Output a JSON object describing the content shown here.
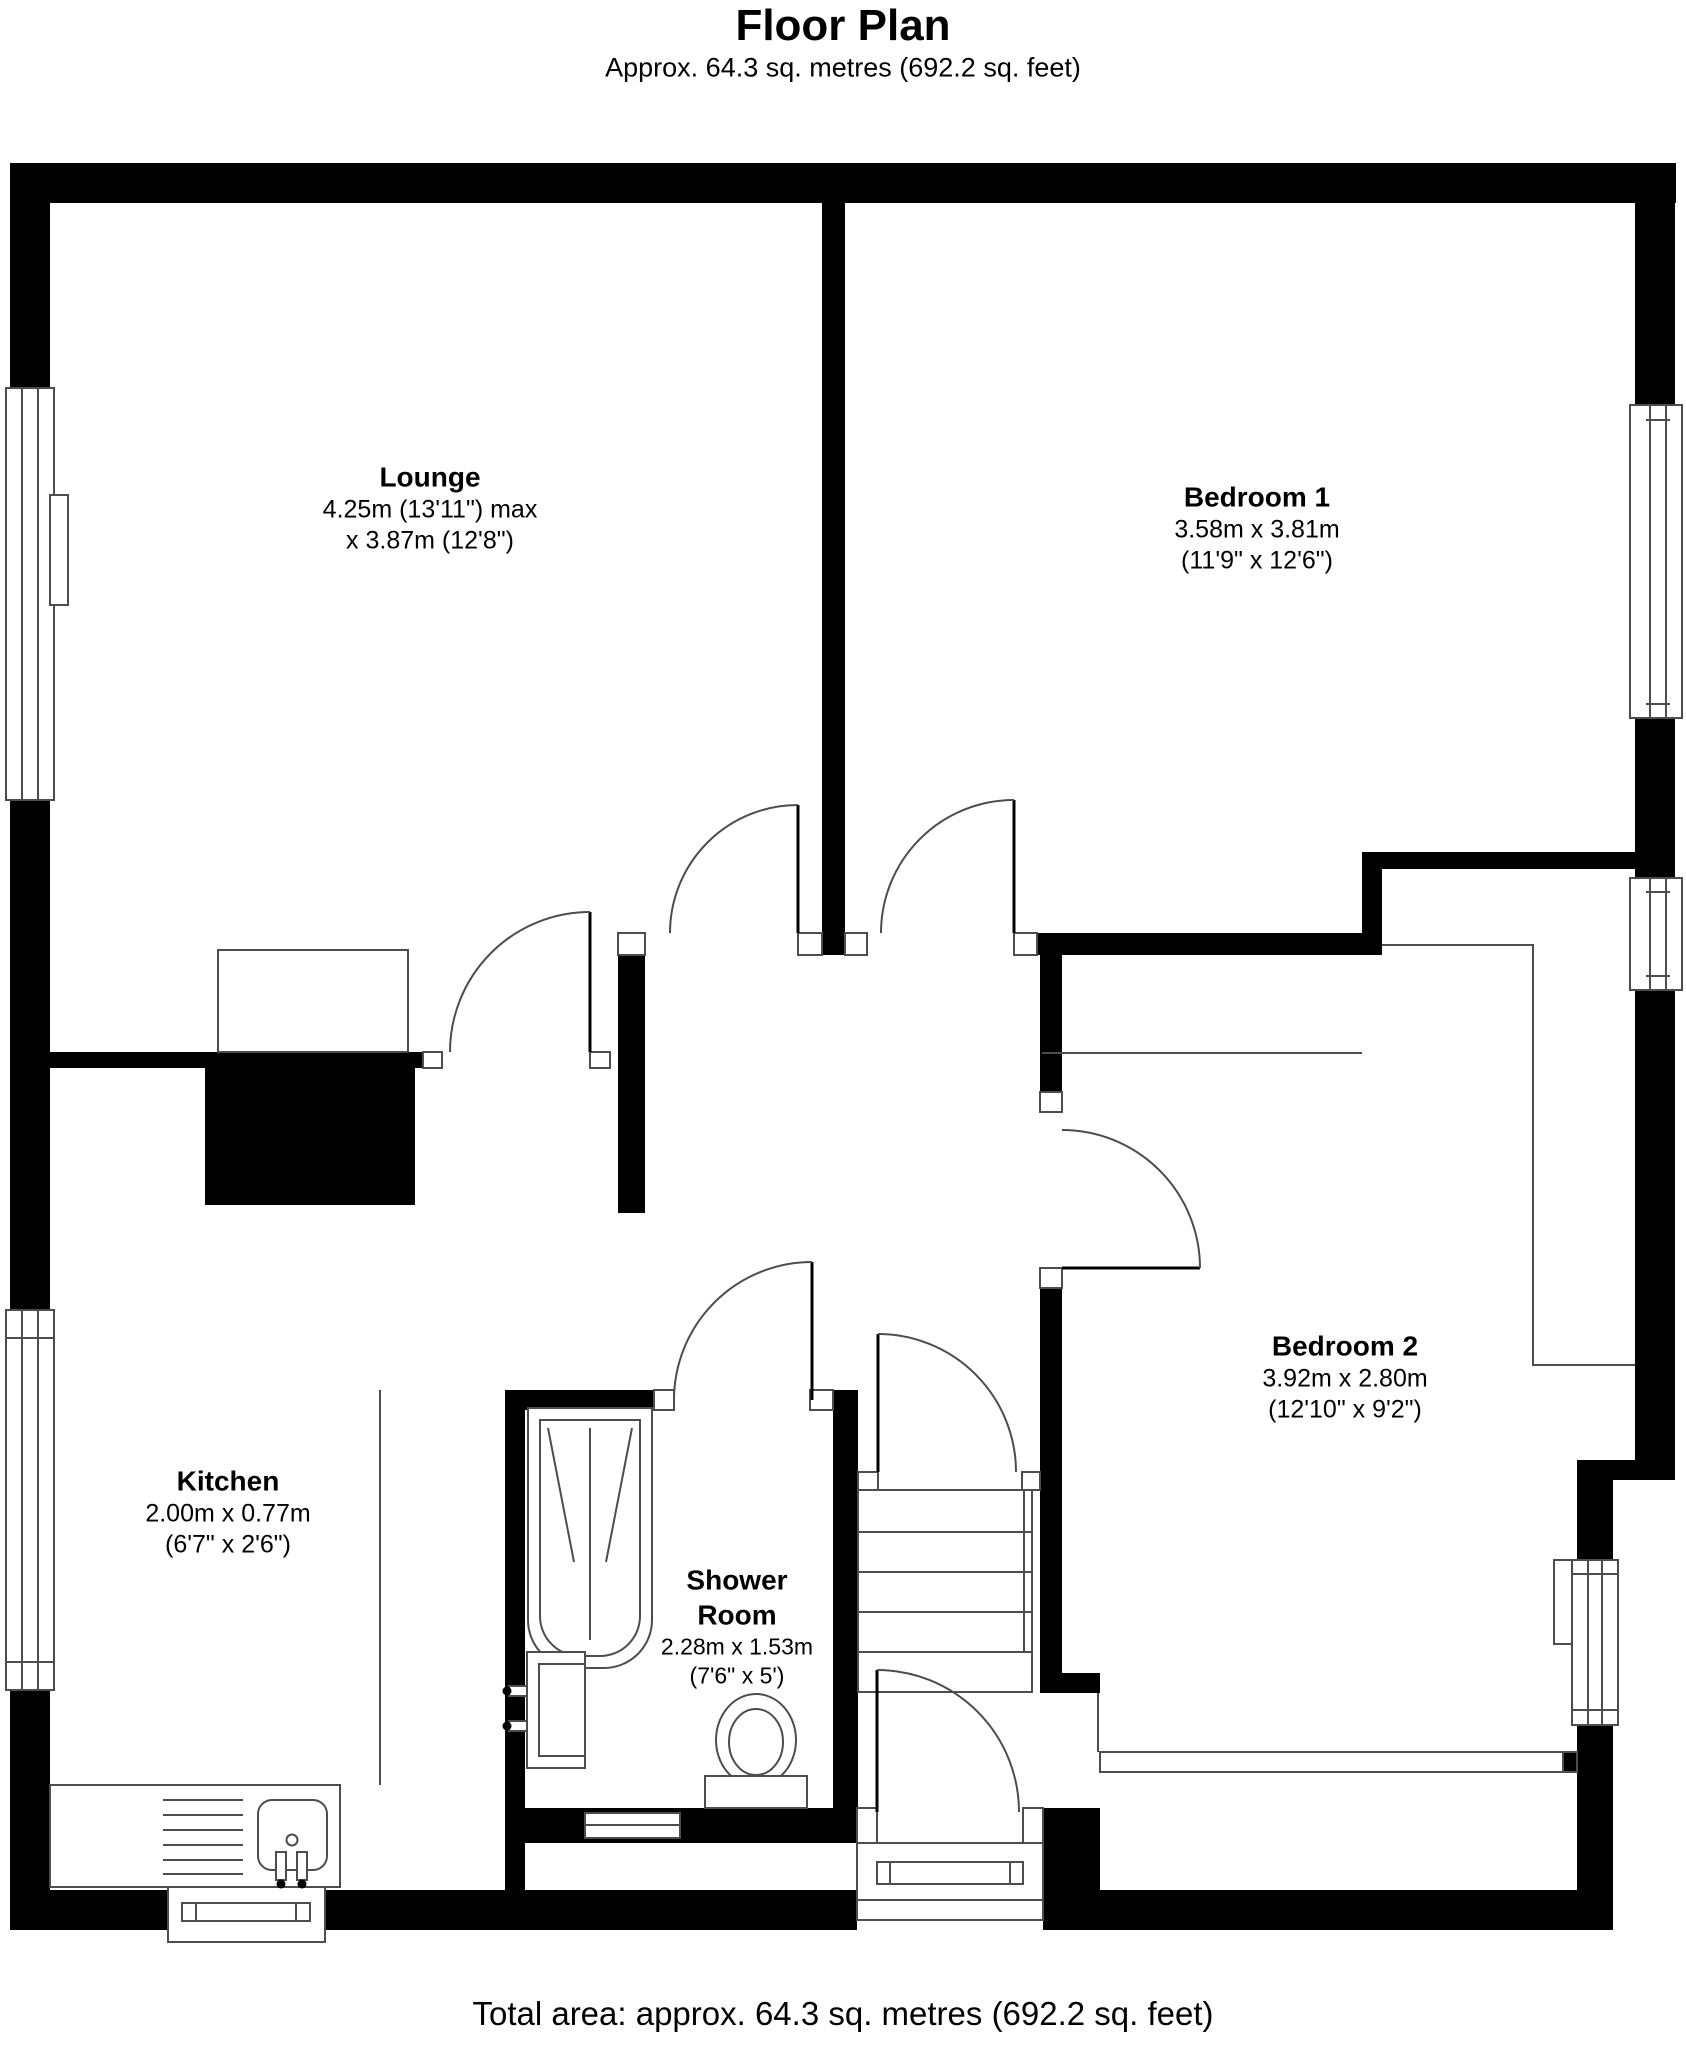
{
  "header": {
    "title": "Floor Plan",
    "subtitle": "Approx. 64.3 sq. metres (692.2 sq. feet)"
  },
  "footer": {
    "total_area": "Total area: approx. 64.3 sq. metres (692.2 sq. feet)"
  },
  "rooms": {
    "lounge": {
      "name": "Lounge",
      "dim_metric": "4.25m (13'11\") max",
      "dim_imperial": "x 3.87m (12'8\")"
    },
    "bedroom1": {
      "name": "Bedroom 1",
      "dim_metric": "3.58m x 3.81m",
      "dim_imperial": "(11'9\" x 12'6\")"
    },
    "bedroom2": {
      "name": "Bedroom 2",
      "dim_metric": "3.92m x 2.80m",
      "dim_imperial": "(12'10\" x 9'2\")"
    },
    "kitchen": {
      "name": "Kitchen",
      "dim_metric": "2.00m x 0.77m",
      "dim_imperial": "(6'7\" x 2'6\")"
    },
    "shower_room": {
      "name": "Shower Room",
      "dim_metric": "2.28m x 1.53m",
      "dim_imperial": "(7'6\" x 5')"
    }
  },
  "colors": {
    "wall": "#000000",
    "thin_line": "#4d4d4d",
    "background": "#ffffff"
  }
}
